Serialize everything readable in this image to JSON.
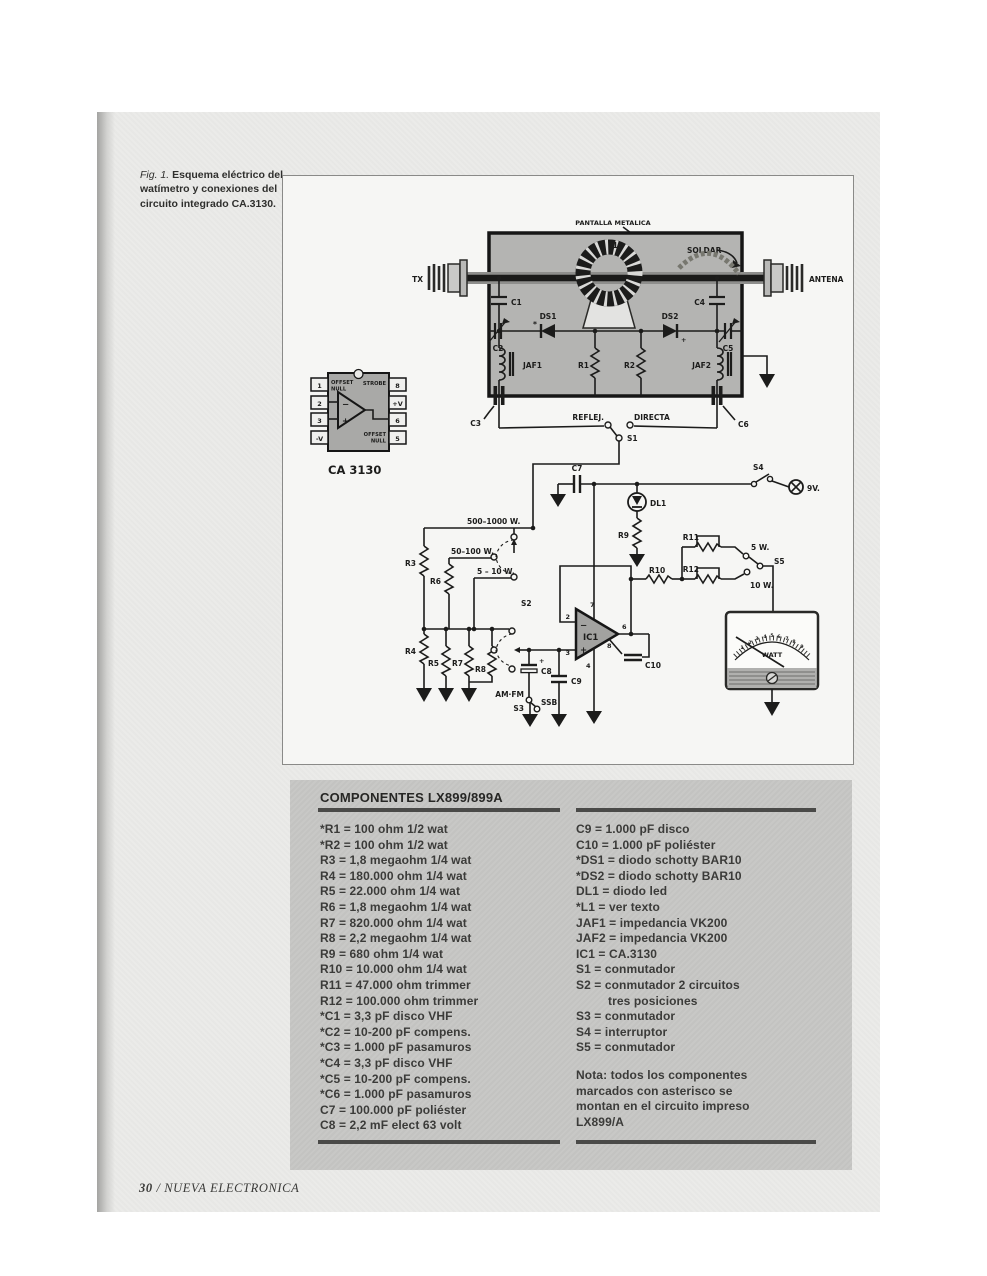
{
  "caption": {
    "fig": "Fig. 1.",
    "text": " Esquema eléctrico del watímetro y conexiones del circuito integrado CA.3130."
  },
  "footer": {
    "page_number": "30",
    "magazine": "/ NUEVA ELECTRONICA"
  },
  "schematic": {
    "labels": {
      "pantalla": "PANTALLA METALICA",
      "soldar": "SOLDAR",
      "tx": "TX",
      "antena": "ANTENA",
      "l1": "L1",
      "c1": "C1",
      "c2": "C2",
      "c3": "C3",
      "c4": "C4",
      "c5": "C5",
      "c6": "C6",
      "c7": "C7",
      "ds1": "DS1",
      "ds1_star": "*",
      "ds2": "DS2",
      "ds2_plus": "+",
      "jaf1": "JAF1",
      "jaf2": "JAF2",
      "r1": "R1",
      "r2": "R2",
      "r3": "R3",
      "r4": "R4",
      "r5": "R5",
      "r6": "R6",
      "r7": "R7",
      "r8": "R8",
      "r9": "R9",
      "r10": "R10",
      "r11": "R11",
      "r12": "R12",
      "reflej": "REFLEJ.",
      "directa": "DIRECTA",
      "s1": "S1",
      "s2": "S2",
      "s3": "S3",
      "s4": "S4",
      "s5": "S5",
      "v9": "9V.",
      "dl1": "DL1",
      "w500": "500–1000 W.",
      "w50": "50–100 W.",
      "w5": "5 – 10 W.",
      "w5_out": "5 W.",
      "w10_out": "10 W.",
      "c8": "C8",
      "c8_plus": "+",
      "c9": "C9",
      "c10": "C10",
      "amfm": "AM·FM",
      "ssb": "SSB",
      "ic1": "IC1",
      "pin2": "2",
      "pin3": "3",
      "pin4": "4",
      "pin6": "6",
      "pin7": "7",
      "pin8": "8",
      "op_minus": "−",
      "op_plus": "+",
      "watt": "WATT"
    },
    "dip": {
      "pins_left": [
        "1",
        "2",
        "3",
        "-V"
      ],
      "pins_right": [
        "8",
        "+V",
        "6",
        "5"
      ],
      "offset_top_1": "OFFSET",
      "offset_top_2": "NULL",
      "strobe": "STROBE",
      "offset_bot_1": "OFFSET",
      "offset_bot_2": "NULL",
      "minus": "−",
      "plus": "+",
      "title": "CA 3130"
    },
    "meter_scale": [
      "1",
      "2",
      "3",
      "4",
      "5",
      "6",
      "7",
      "8",
      "9"
    ]
  },
  "components": {
    "title": "COMPONENTES LX899/899A",
    "left": [
      "*R1 = 100 ohm 1/2 wat",
      "*R2 = 100 ohm 1/2 wat",
      "R3 = 1,8 megaohm 1/4 wat",
      "R4 = 180.000 ohm 1/4 wat",
      "R5 = 22.000 ohm 1/4 wat",
      "R6 = 1,8 megaohm 1/4 wat",
      "R7 = 820.000 ohm 1/4 wat",
      "R8 = 2,2 megaohm 1/4 wat",
      "R9 = 680 ohm 1/4 wat",
      "R10 = 10.000 ohm 1/4 wat",
      "R11 = 47.000 ohm trimmer",
      "R12 = 100.000 ohm trimmer",
      "*C1 = 3,3 pF disco VHF",
      "*C2 = 10-200 pF compens.",
      "*C3 = 1.000 pF pasamuros",
      "*C4 = 3,3 pF disco VHF",
      "*C5 = 10-200 pF compens.",
      "*C6 = 1.000 pF pasamuros",
      "C7 = 100.000 pF poliéster",
      "C8 = 2,2 mF elect 63 volt"
    ],
    "right": [
      "C9 = 1.000 pF disco",
      "C10 = 1.000 pF poliéster",
      "*DS1 = diodo schotty BAR10",
      "*DS2 = diodo schotty BAR10",
      "DL1 = diodo led",
      "*L1 = ver texto",
      "JAF1 = impedancia VK200",
      "JAF2 = impedancia VK200",
      "IC1 = CA.3130",
      "S1 = conmutador",
      "S2 = conmutador 2 circuitos",
      "tres posiciones",
      "S3 = conmutador",
      "S4 = interruptor",
      "S5 = conmutador"
    ],
    "note": "Nota: todos los componentes\nmarcados con asterisco se\nmontan en el circuito impreso\nLX899/A"
  }
}
